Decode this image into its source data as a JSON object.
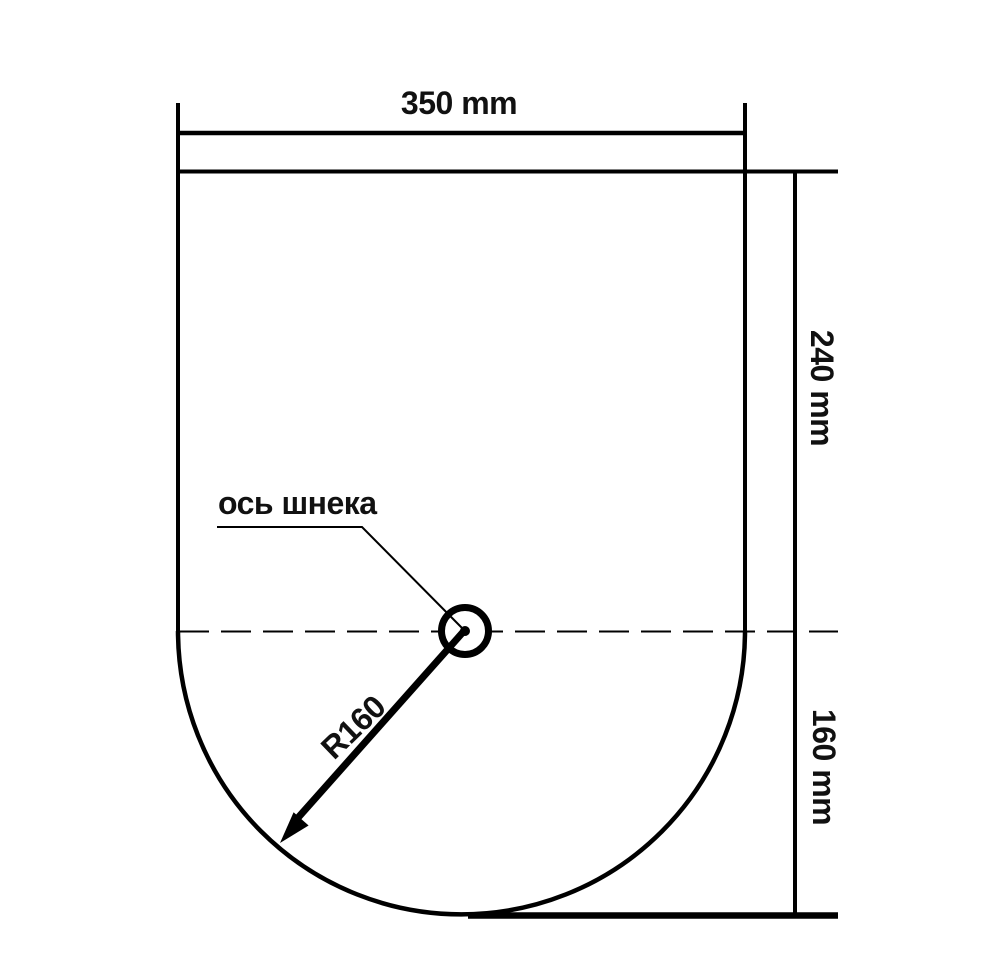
{
  "drawing": {
    "type": "technical-cross-section",
    "background_color": "#ffffff",
    "line_color": "#000000",
    "labels": {
      "top_width": "350 mm",
      "upper_height": "240 mm",
      "lower_height": "160 mm",
      "radius": "R160",
      "axis": "ось шнека"
    },
    "values": {
      "top_width_mm": 350,
      "upper_height_mm": 240,
      "lower_height_mm": 160,
      "radius_mm": 160
    }
  }
}
